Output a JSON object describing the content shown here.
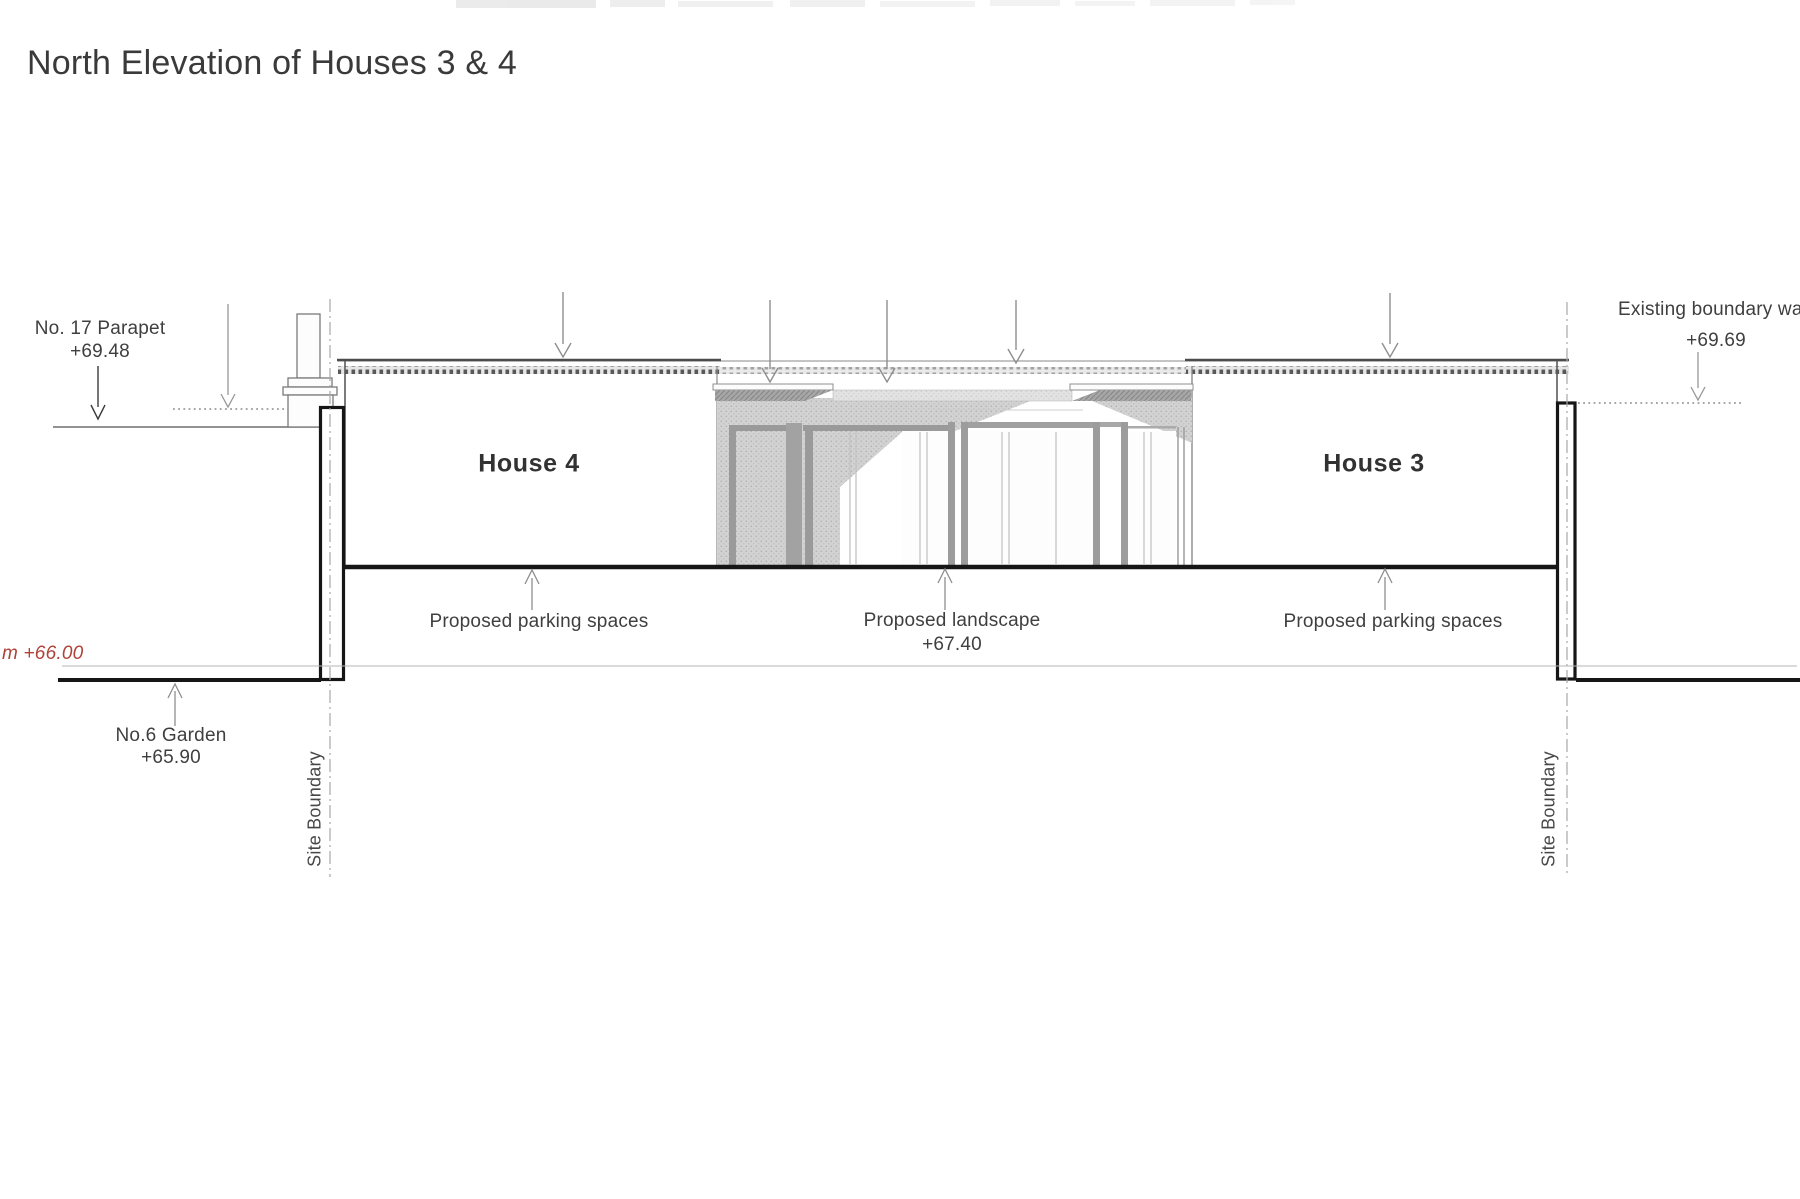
{
  "title": "North Elevation of Houses 3 & 4",
  "houses": {
    "house4_label": "House 4",
    "house3_label": "House 3"
  },
  "annotations": {
    "no17_parapet_line1": "No. 17 Parapet",
    "no17_parapet_line2": "+69.48",
    "existing_boundary_line1": "Existing boundary wall",
    "existing_boundary_line2": "+69.69",
    "no6_garden_line1": "No.6 Garden",
    "no6_garden_line2": "+65.90",
    "datum_text": "m +66.00",
    "site_boundary_left": "Site Boundary",
    "site_boundary_right": "Site Boundary",
    "parking_left": "Proposed parking spaces",
    "landscape_line1": "Proposed landscape",
    "landscape_line2": "+67.40",
    "parking_right": "Proposed parking spaces"
  },
  "colors": {
    "ink": "#3f3f3f",
    "heavy_line": "#141414",
    "light_line": "#9b9b9b",
    "datum_red": "#b04238",
    "background": "#ffffff"
  }
}
